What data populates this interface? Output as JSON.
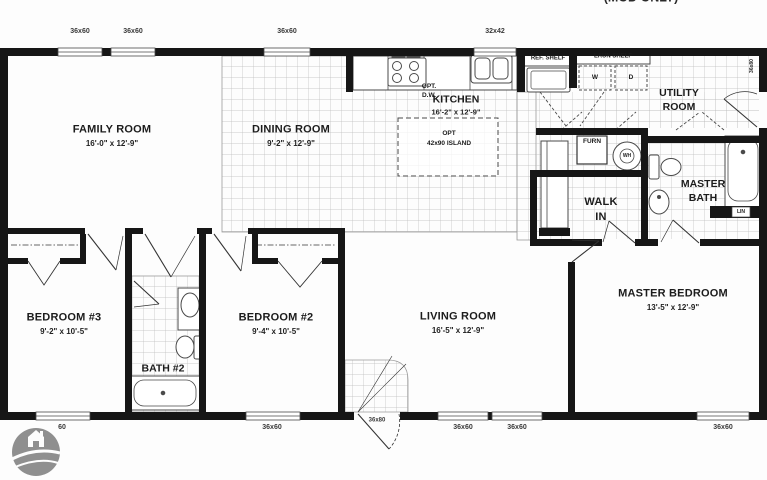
{
  "plan": {
    "note": "(MOD ONLY)",
    "rooms": {
      "family_room": {
        "name": "FAMILY ROOM",
        "dims": "16'-0\" x 12'-9\""
      },
      "dining_room": {
        "name": "DINING ROOM",
        "dims": "9'-2\" x 12'-9\""
      },
      "kitchen": {
        "name": "KITCHEN",
        "dims": "16'-2\" x 12'-9\""
      },
      "utility_room": {
        "line1": "UTILITY",
        "line2": "ROOM"
      },
      "walk_in": {
        "line1": "WALK",
        "line2": "IN"
      },
      "master_bath": {
        "line1": "MASTER",
        "line2": "BATH"
      },
      "master_bedroom": {
        "name": "MASTER BEDROOM",
        "dims": "13'-5\" x 12'-9\""
      },
      "living_room": {
        "name": "LIVING ROOM",
        "dims": "16'-5\" x 12'-9\""
      },
      "bedroom2": {
        "name": "BEDROOM #2",
        "dims": "9'-4\" x 10'-5\""
      },
      "bedroom3": {
        "name": "BEDROOM #3",
        "dims": "9'-2\" x 10'-5\""
      },
      "bath2": {
        "name": "BATH #2"
      }
    },
    "annotations": {
      "ref_shelf": "REF. SHELF",
      "laun_shelf": "LAUN SHELF",
      "washer": "W",
      "dryer": "D",
      "furnace": "FURN",
      "water_heater": "WH",
      "linen": "LIN",
      "opt_dw_1": "OPT.",
      "opt_dw_2": "D.W.",
      "island_1": "OPT",
      "island_2": "42x90 ISLAND"
    },
    "openings": {
      "top_windows": [
        "36x60",
        "36x60",
        "36x60",
        "32x42"
      ],
      "bottom_windows": [
        "60",
        "36x60",
        "36x60",
        "36x60",
        "36x60"
      ],
      "front_door": "36x80",
      "side_door": "36x80"
    },
    "colors": {
      "wall": "#161616",
      "line": "#4a4a4a",
      "tile": "#bcbcbc",
      "logo": "#8f8f8f"
    }
  }
}
